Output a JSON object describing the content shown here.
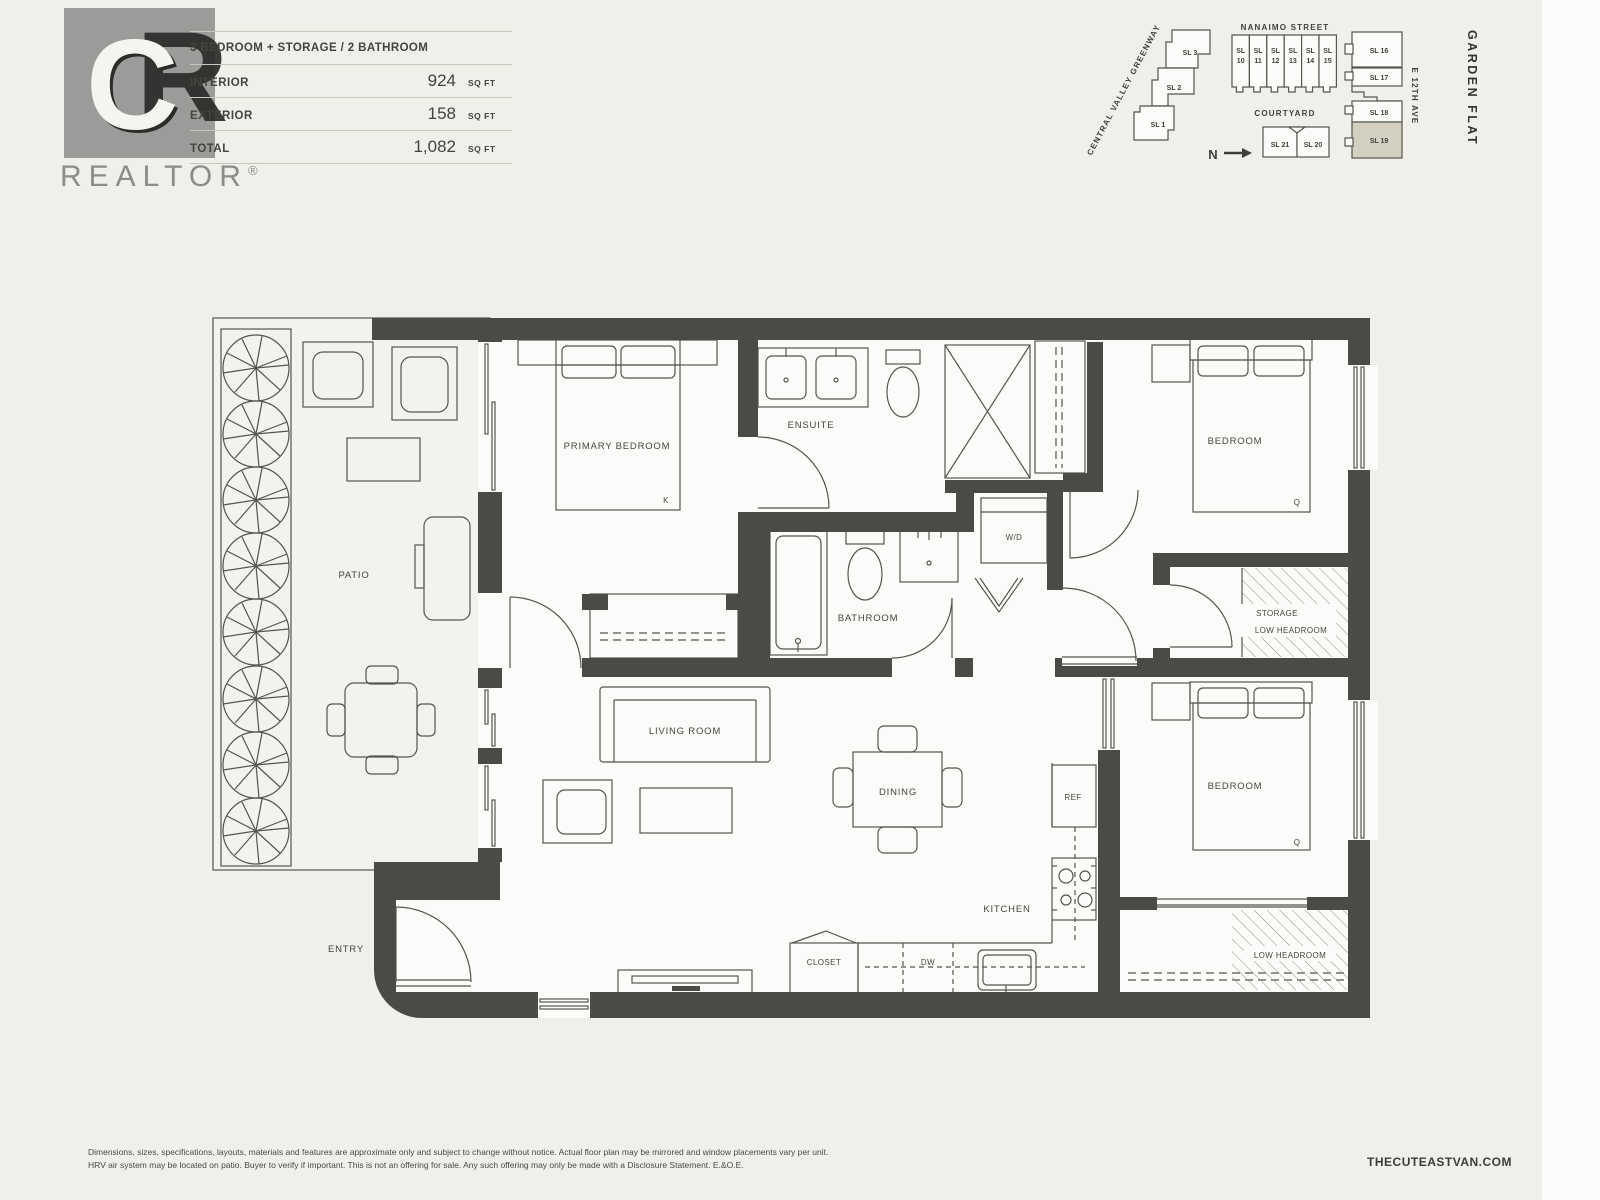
{
  "logo": {
    "monogram_c": "C",
    "monogram_r": "R",
    "wordmark": "REALTOR",
    "registered": "®"
  },
  "header": {
    "plan_title": "3 BEDROOM + STORAGE / 2 BATHROOM",
    "rows": [
      {
        "label": "INTERIOR",
        "value": "924",
        "unit": "SQ FT"
      },
      {
        "label": "EXTERIOR",
        "value": "158",
        "unit": "SQ FT"
      },
      {
        "label": "TOTAL",
        "value": "1,082",
        "unit": "SQ FT"
      }
    ]
  },
  "siteplan": {
    "streets": {
      "nanaimo": "NANAIMO STREET",
      "greenway": "CENTRAL VALLEY GREENWAY",
      "e12th": "E 12TH AVE",
      "courtyard": "COURTYARD"
    },
    "north_label": "N",
    "plan_name": "GARDEN FLAT",
    "left_buildings": [
      "SL 3",
      "SL 2",
      "SL 1"
    ],
    "street_row": [
      {
        "l1": "SL",
        "l2": "10"
      },
      {
        "l1": "SL",
        "l2": "11"
      },
      {
        "l1": "SL",
        "l2": "12"
      },
      {
        "l1": "SL",
        "l2": "13"
      },
      {
        "l1": "SL",
        "l2": "14"
      },
      {
        "l1": "SL",
        "l2": "15"
      }
    ],
    "courtyard_row": [
      "SL 21",
      "SL 20"
    ],
    "right_column": [
      "SL 16",
      "SL 17",
      "SL 18",
      "SL 19"
    ],
    "highlighted_unit": "SL 19"
  },
  "floorplan": {
    "rooms": {
      "primary_bedroom": "PRIMARY BEDROOM",
      "ensuite": "ENSUITE",
      "bedroom": "BEDROOM",
      "bathroom": "BATHROOM",
      "living_room": "LIVING ROOM",
      "dining": "DINING",
      "kitchen": "KITCHEN",
      "patio": "PATIO",
      "entry": "ENTRY",
      "closet": "CLOSET",
      "storage": "STORAGE",
      "low_headroom": "LOW HEADROOM",
      "laundry": "W/D",
      "dishwasher": "DW",
      "fridge": "REF",
      "bed_king": "K",
      "bed_queen": "Q"
    }
  },
  "footer": {
    "disclaimer_line1": "Dimensions, sizes, specifications, layouts, materials and features are approximate only and subject to change without notice. Actual floor plan may be mirrored and window placements vary per unit.",
    "disclaimer_line2": "HRV air system may be located on patio. Buyer to verify if important. This is not an offering for sale. Any such offering may only be made with a Disclosure Statement. E.&O.E.",
    "website": "THECUTEASTVAN.COM"
  },
  "colors": {
    "background": "#f0efe9",
    "wall": "#4a4a46",
    "line": "#55554f",
    "room_fill": "#fbfbf9",
    "patio_fill": "#f3f2ec",
    "highlight_unit": "#d3d0c2",
    "hatch": "#90908a",
    "text": "#44443f",
    "logo_gray": "#9b9b99"
  }
}
